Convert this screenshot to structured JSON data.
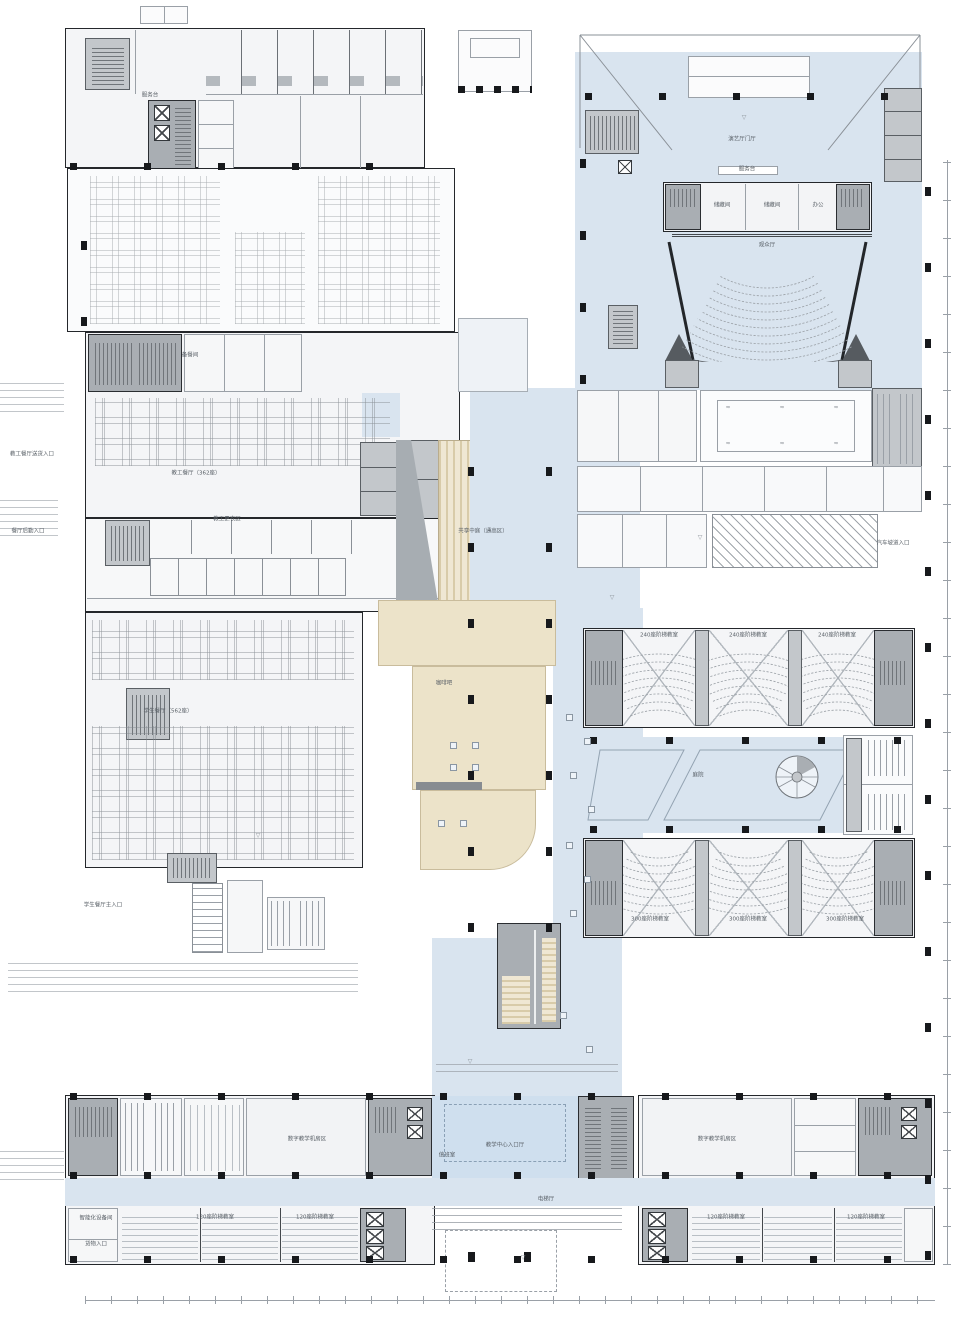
{
  "meta": {
    "type": "architectural-floor-plan",
    "discipline": "campus teaching-center first floor plan",
    "language": "zh-CN"
  },
  "colors": {
    "circulation_blue": "#d9e4ef",
    "entrance_blue": "#cfdfee",
    "core_gray": "#a9aeb3",
    "secondary_gray": "#c3c7cb",
    "step_beige": "#ece3c9",
    "wall_black": "#24272b",
    "line_gray": "#9aa0a7",
    "label_gray": "#596067"
  },
  "glyphs": {
    "water_mark": "≈",
    "elevation_marker": "▽"
  },
  "plan": {
    "labels": [
      {
        "id": "service-desk-left",
        "text": "服务台",
        "x": 150,
        "y": 96
      },
      {
        "id": "prep-room",
        "text": "备餐间",
        "x": 190,
        "y": 356
      },
      {
        "id": "staff-dining",
        "text": "教工餐厅（362座）",
        "x": 196,
        "y": 474
      },
      {
        "id": "staff-locker",
        "text": "教工更衣区",
        "x": 227,
        "y": 520
      },
      {
        "id": "student-dining",
        "text": "学生餐厅（562座）",
        "x": 168,
        "y": 712
      },
      {
        "id": "cafe",
        "text": "咖啡吧",
        "x": 444,
        "y": 684
      },
      {
        "id": "shared-atrium",
        "text": "共享中庭（通高区）",
        "x": 483,
        "y": 532
      },
      {
        "id": "perf-hall-lobby",
        "text": "演艺厅门厅",
        "x": 742,
        "y": 140
      },
      {
        "id": "service-desk-auditorium",
        "text": "服务台",
        "x": 747,
        "y": 170
      },
      {
        "id": "audience-hall",
        "text": "观众厅",
        "x": 767,
        "y": 246
      },
      {
        "id": "storage-1",
        "text": "储藏间",
        "x": 722,
        "y": 206
      },
      {
        "id": "storage-2",
        "text": "储藏间",
        "x": 772,
        "y": 206
      },
      {
        "id": "office",
        "text": "办公",
        "x": 818,
        "y": 206
      },
      {
        "id": "courtyard",
        "text": "庭院",
        "x": 698,
        "y": 776
      },
      {
        "id": "hall240-1",
        "text": "240座阶梯教室",
        "x": 659,
        "y": 636
      },
      {
        "id": "hall240-2",
        "text": "240座阶梯教室",
        "x": 748,
        "y": 636
      },
      {
        "id": "hall240-3",
        "text": "240座阶梯教室",
        "x": 837,
        "y": 636
      },
      {
        "id": "hall300-1",
        "text": "300座阶梯教室",
        "x": 650,
        "y": 920
      },
      {
        "id": "hall300-2",
        "text": "300座阶梯教室",
        "x": 748,
        "y": 920
      },
      {
        "id": "hall300-3",
        "text": "300座阶梯教室",
        "x": 845,
        "y": 920
      },
      {
        "id": "entry-hall",
        "text": "教学中心入口厅",
        "x": 505,
        "y": 1146
      },
      {
        "id": "duty-room",
        "text": "值班室",
        "x": 447,
        "y": 1156
      },
      {
        "id": "elevator-hall",
        "text": "电梯厅",
        "x": 546,
        "y": 1200
      },
      {
        "id": "machine-room-left",
        "text": "数字教学机房区",
        "x": 307,
        "y": 1140
      },
      {
        "id": "machine-room-right",
        "text": "数字教学机房区",
        "x": 717,
        "y": 1140
      },
      {
        "id": "hall120-1",
        "text": "120座阶梯教室",
        "x": 215,
        "y": 1218
      },
      {
        "id": "hall120-2",
        "text": "120座阶梯教室",
        "x": 315,
        "y": 1218
      },
      {
        "id": "hall120-3",
        "text": "120座阶梯教室",
        "x": 726,
        "y": 1218
      },
      {
        "id": "hall120-4",
        "text": "120座阶梯教室",
        "x": 866,
        "y": 1218
      },
      {
        "id": "student-dining-entry",
        "text": "学生餐厅主入口",
        "x": 103,
        "y": 906
      },
      {
        "id": "smart-equipment",
        "text": "智能化设备间",
        "x": 96,
        "y": 1219
      },
      {
        "id": "cargo-entry",
        "text": "货物入口",
        "x": 96,
        "y": 1245
      },
      {
        "id": "delivery-entry",
        "text": "教工餐厅送货入口",
        "x": 32,
        "y": 455
      },
      {
        "id": "logistics-entry",
        "text": "餐厅后勤入口",
        "x": 28,
        "y": 532
      },
      {
        "id": "car-ramp-entry",
        "text": "汽车坡道入口",
        "x": 893,
        "y": 544
      }
    ],
    "elev_markers": [
      {
        "x": 744,
        "y": 118
      },
      {
        "x": 612,
        "y": 598
      },
      {
        "x": 470,
        "y": 1062
      },
      {
        "x": 258,
        "y": 836
      },
      {
        "x": 523,
        "y": 1258
      },
      {
        "x": 700,
        "y": 538
      }
    ],
    "water_marks": [
      {
        "x": 728,
        "y": 408
      },
      {
        "x": 782,
        "y": 408
      },
      {
        "x": 836,
        "y": 408
      },
      {
        "x": 728,
        "y": 444
      },
      {
        "x": 782,
        "y": 444
      },
      {
        "x": 836,
        "y": 444
      }
    ],
    "furniture": [
      {
        "x": 566,
        "y": 714
      },
      {
        "x": 584,
        "y": 738
      },
      {
        "x": 570,
        "y": 772
      },
      {
        "x": 588,
        "y": 806
      },
      {
        "x": 566,
        "y": 842
      },
      {
        "x": 584,
        "y": 876
      },
      {
        "x": 570,
        "y": 910
      },
      {
        "x": 560,
        "y": 1012
      },
      {
        "x": 586,
        "y": 1046
      },
      {
        "x": 450,
        "y": 742
      },
      {
        "x": 472,
        "y": 742
      },
      {
        "x": 450,
        "y": 764
      },
      {
        "x": 472,
        "y": 764
      },
      {
        "x": 438,
        "y": 820
      },
      {
        "x": 460,
        "y": 820
      }
    ]
  }
}
